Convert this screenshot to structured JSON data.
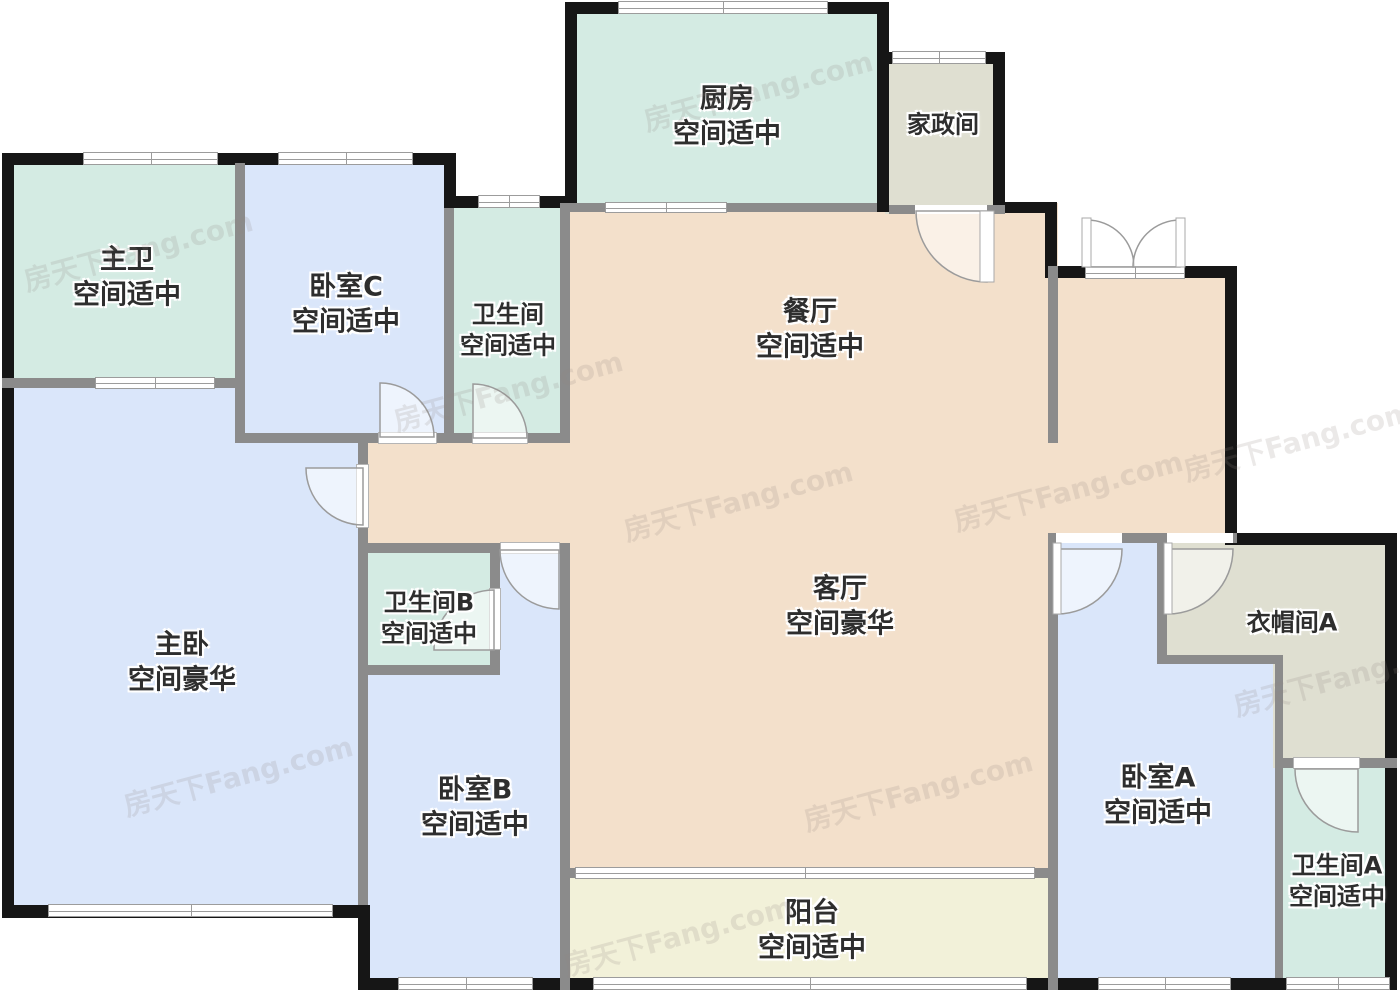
{
  "floorplan": {
    "title": "户型图",
    "watermark": "房天下Fang.com",
    "rooms": [
      {
        "id": "kitchen",
        "name": "厨房",
        "desc": "空间适中"
      },
      {
        "id": "housekeeping",
        "name": "家政间",
        "desc": ""
      },
      {
        "id": "master-bath",
        "name": "主卫",
        "desc": "空间适中"
      },
      {
        "id": "bedroom-c",
        "name": "卧室C",
        "desc": "空间适中"
      },
      {
        "id": "bathroom",
        "name": "卫生间",
        "desc": "空间适中"
      },
      {
        "id": "dining",
        "name": "餐厅",
        "desc": "空间适中"
      },
      {
        "id": "living",
        "name": "客厅",
        "desc": "空间豪华"
      },
      {
        "id": "master-bedroom",
        "name": "主卧",
        "desc": "空间豪华"
      },
      {
        "id": "bathroom-b",
        "name": "卫生间B",
        "desc": "空间适中"
      },
      {
        "id": "bedroom-b",
        "name": "卧室B",
        "desc": "空间适中"
      },
      {
        "id": "bedroom-a",
        "name": "卧室A",
        "desc": "空间适中"
      },
      {
        "id": "cloakroom-a",
        "name": "衣帽间A",
        "desc": ""
      },
      {
        "id": "bathroom-a",
        "name": "卫生间A",
        "desc": "空间适中"
      },
      {
        "id": "balcony",
        "name": "阳台",
        "desc": "空间适中"
      }
    ],
    "colors": {
      "bathroom_mint": "#d4ebe3",
      "bedroom_blue": "#dae6fa",
      "living_peach": "#f3e0cb",
      "utility_beige": "#dfdfd1",
      "balcony_yellow": "#f2f1d9",
      "exterior_wall": "#161616",
      "interior_wall": "#8b8b8b",
      "label_text": "#2e2e2e"
    }
  }
}
